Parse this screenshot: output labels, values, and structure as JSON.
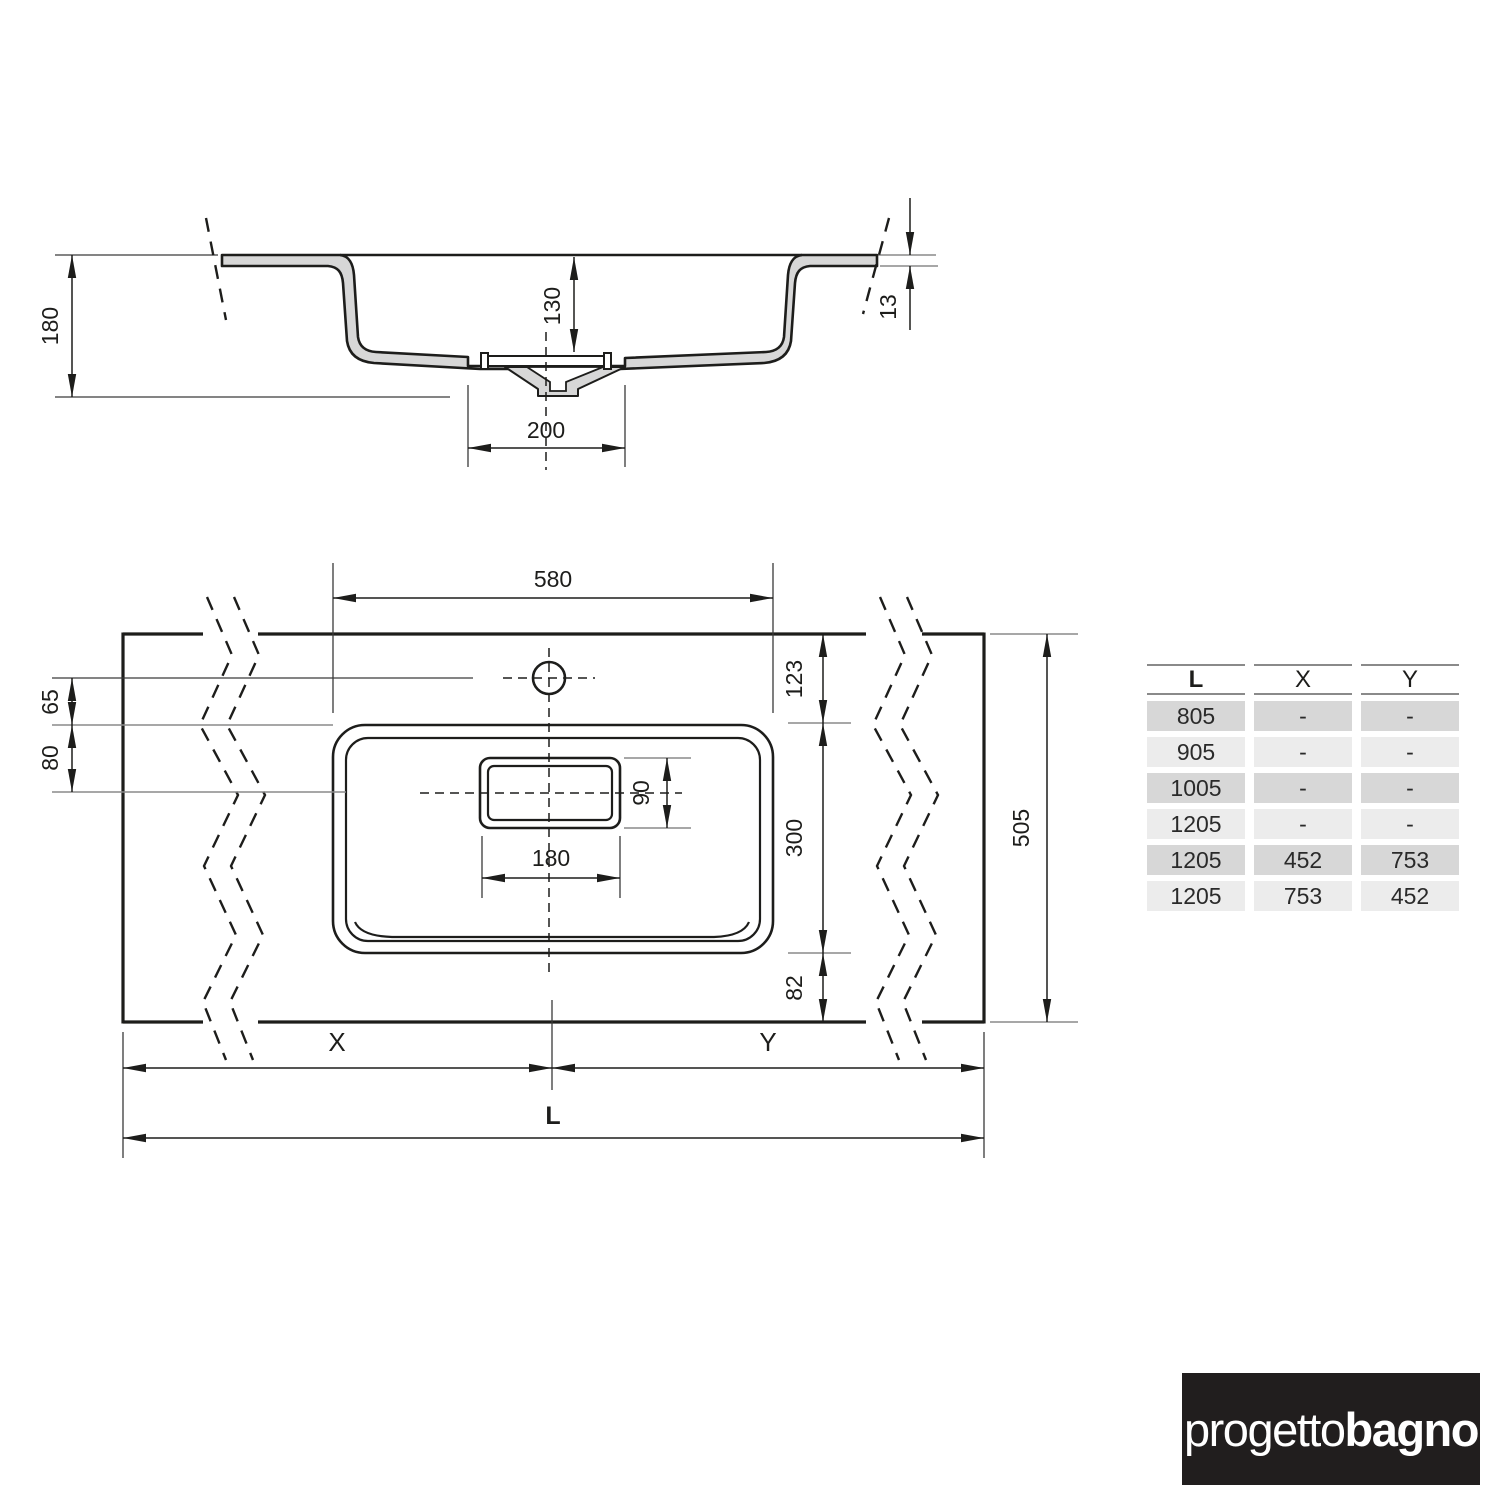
{
  "colors": {
    "line": "#1d1d1b",
    "section_fill": "#d7d7d7",
    "ref_line": "#8a8a8a",
    "table_row_dark": "#d7d7d7",
    "table_row_light": "#ececec",
    "logo_bg": "#211e1e",
    "logo_text": "#ffffff"
  },
  "section_view": {
    "total_height": "180",
    "bowl_depth": "130",
    "drain_width": "200",
    "edge_thickness": "13"
  },
  "plan_view": {
    "basin_width": "580",
    "front_edge_to_basin": "123",
    "hole_offset": "65",
    "hole_to_drain": "80",
    "drain_length": "180",
    "drain_height": "90",
    "basin_depth": "300",
    "basin_to_back_edge": "82",
    "total_depth": "505",
    "left_span_label": "X",
    "right_span_label": "Y",
    "total_length_label": "L"
  },
  "table": {
    "headers": [
      "L",
      "X",
      "Y"
    ],
    "rows": [
      [
        "805",
        "-",
        "-"
      ],
      [
        "905",
        "-",
        "-"
      ],
      [
        "1005",
        "-",
        "-"
      ],
      [
        "1205",
        "-",
        "-"
      ],
      [
        "1205",
        "452",
        "753"
      ],
      [
        "1205",
        "753",
        "452"
      ]
    ]
  },
  "logo": {
    "regular": "progetto",
    "bold": "bagno"
  }
}
